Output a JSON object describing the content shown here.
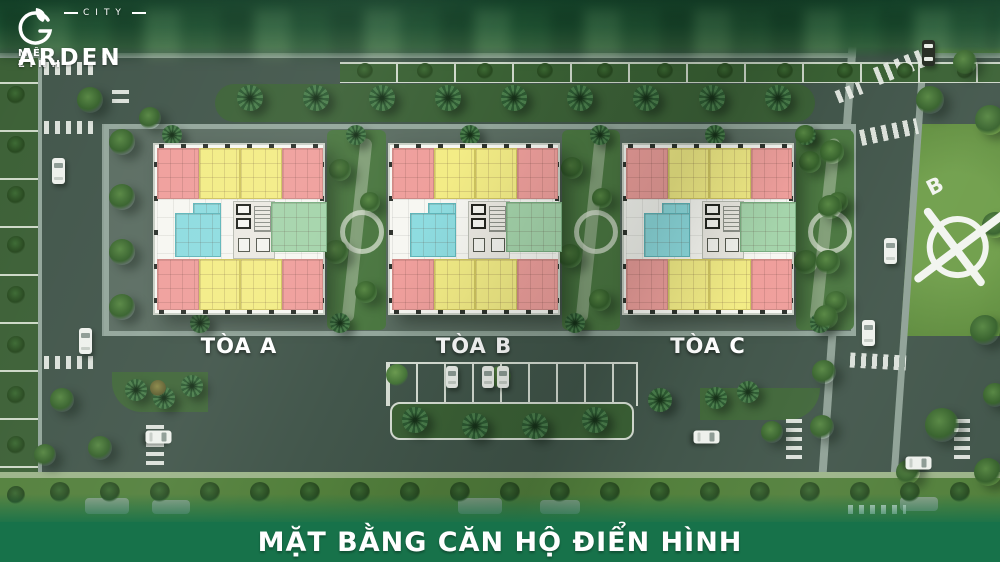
{
  "logo": {
    "top": "MÊ LINH",
    "main_initial": "G",
    "main_rest": "ARDEN",
    "sub": "CITY"
  },
  "buildings": [
    {
      "label": "TÒA A"
    },
    {
      "label": "TÒA B"
    },
    {
      "label": "TÒA C"
    }
  ],
  "banner": {
    "title": "MẶT BẰNG CĂN HỘ ĐIỂN HÌNH",
    "bg": "#17724a"
  },
  "compass": {
    "north_label": "B"
  },
  "palette": {
    "unit_pink": "#ef9f9c",
    "unit_yellow": "#f3ec86",
    "unit_teal": "#8edce0",
    "unit_green": "#a5d4ab"
  }
}
